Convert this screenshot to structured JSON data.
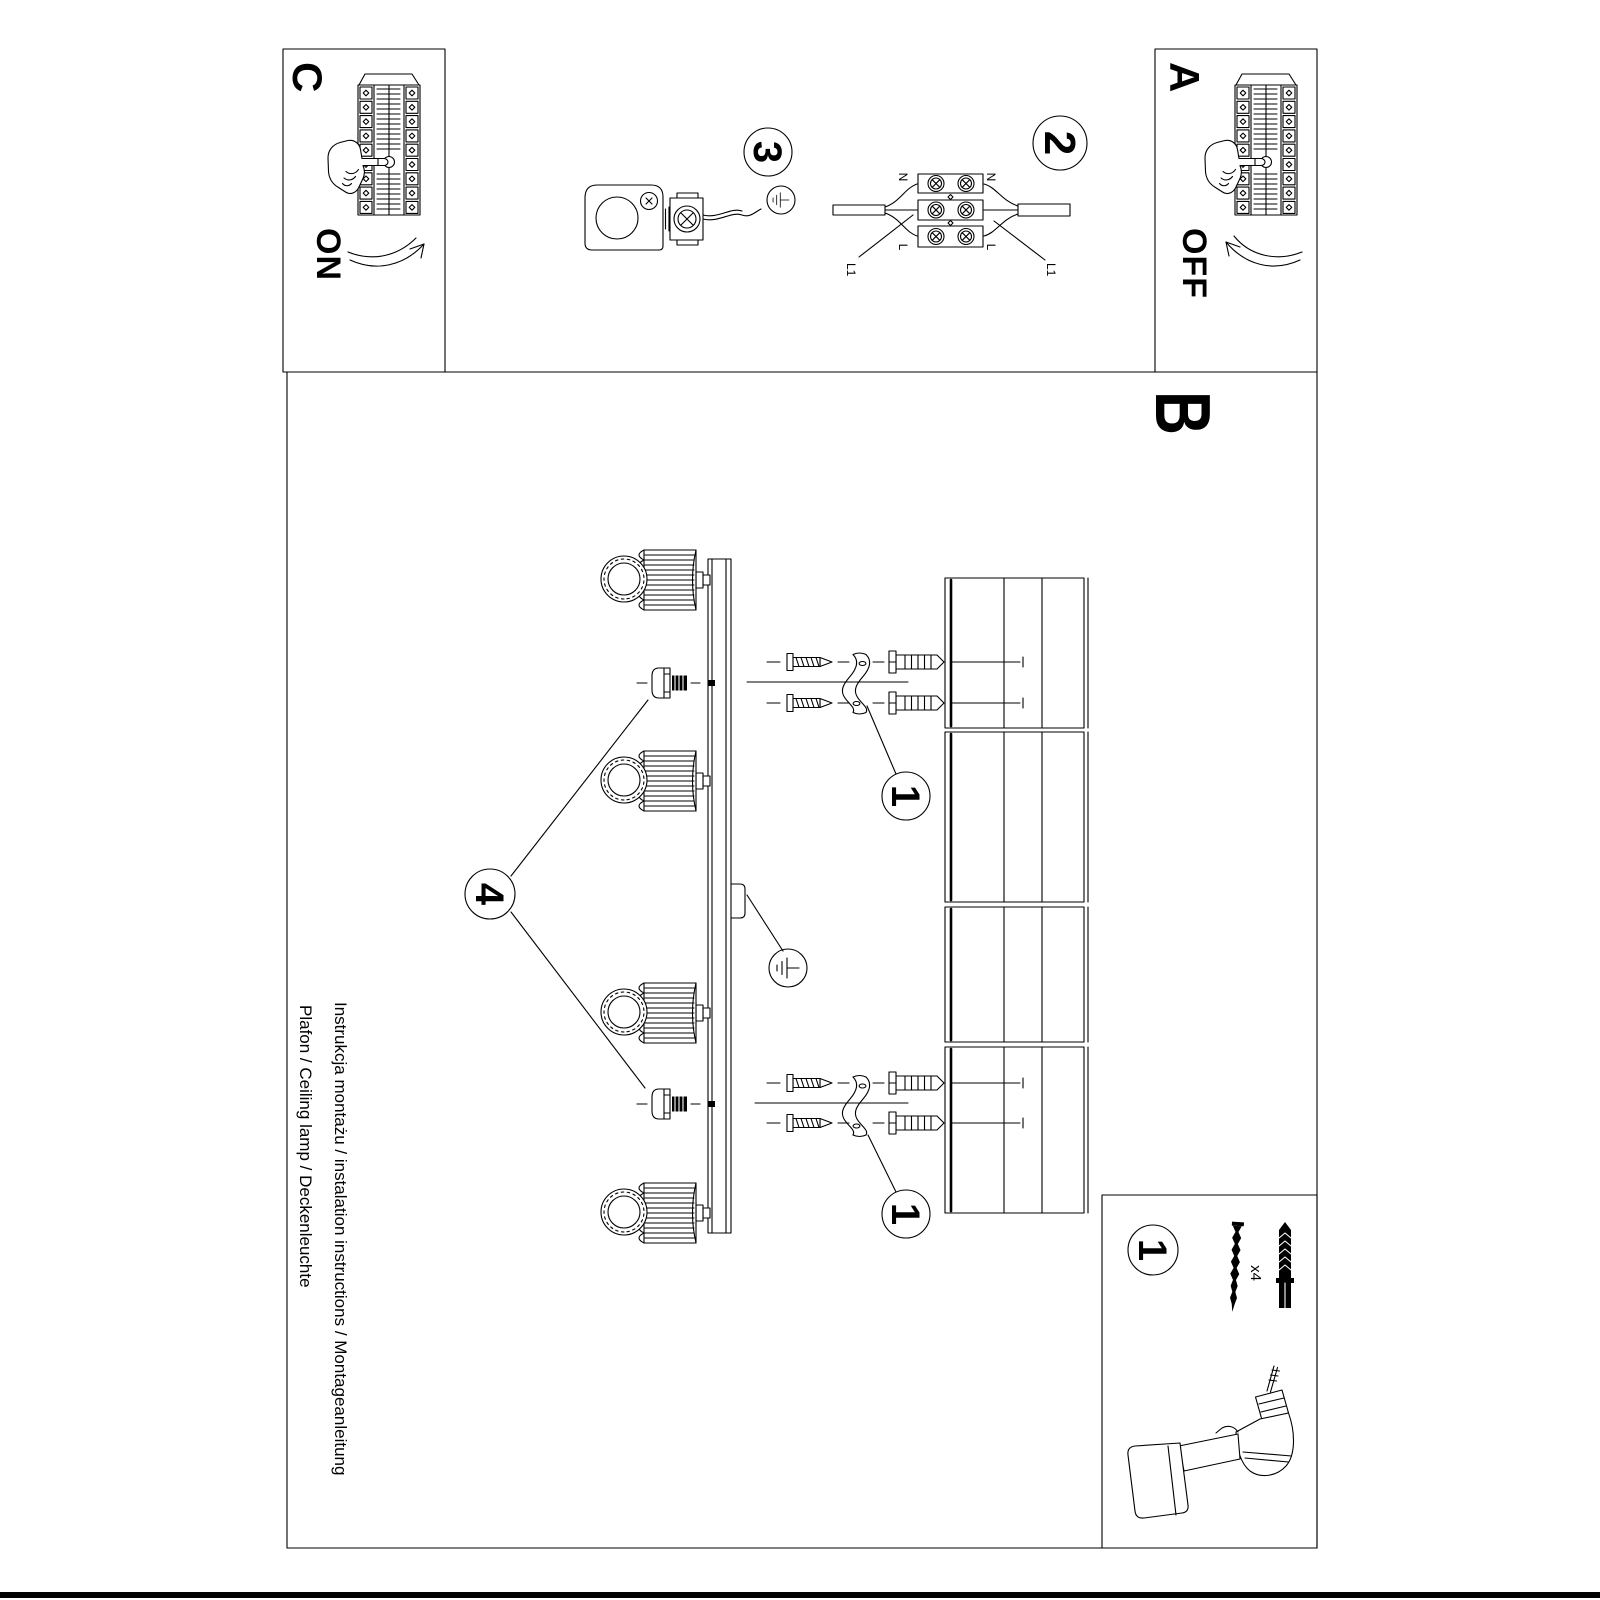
{
  "sheet": {
    "footer_line1": "Instrukcja montażu / instalation instructions / Montageanleitung",
    "footer_line2": "Plafon / Ceiling lamp / Deckenleuchte"
  },
  "panels": {
    "a": "A",
    "b": "B",
    "c": "C",
    "off": "OFF",
    "on": "ON"
  },
  "markers": {
    "step1": "1",
    "step2": "2",
    "step3": "3",
    "step4": "4",
    "parts": "1"
  },
  "wiring": {
    "n_top": "N",
    "n_bottom": "N",
    "l_top": "L",
    "l_bottom": "L",
    "l1_top": "L1",
    "l1_bottom": "L1"
  },
  "parts_box": {
    "qty": "x4"
  },
  "icons": {
    "earth_symbol": "earth-ground-symbol",
    "drill": "cordless-drill",
    "hand": "pointing-hand"
  },
  "colors": {
    "ink": "#000000",
    "paper": "#ffffff"
  }
}
